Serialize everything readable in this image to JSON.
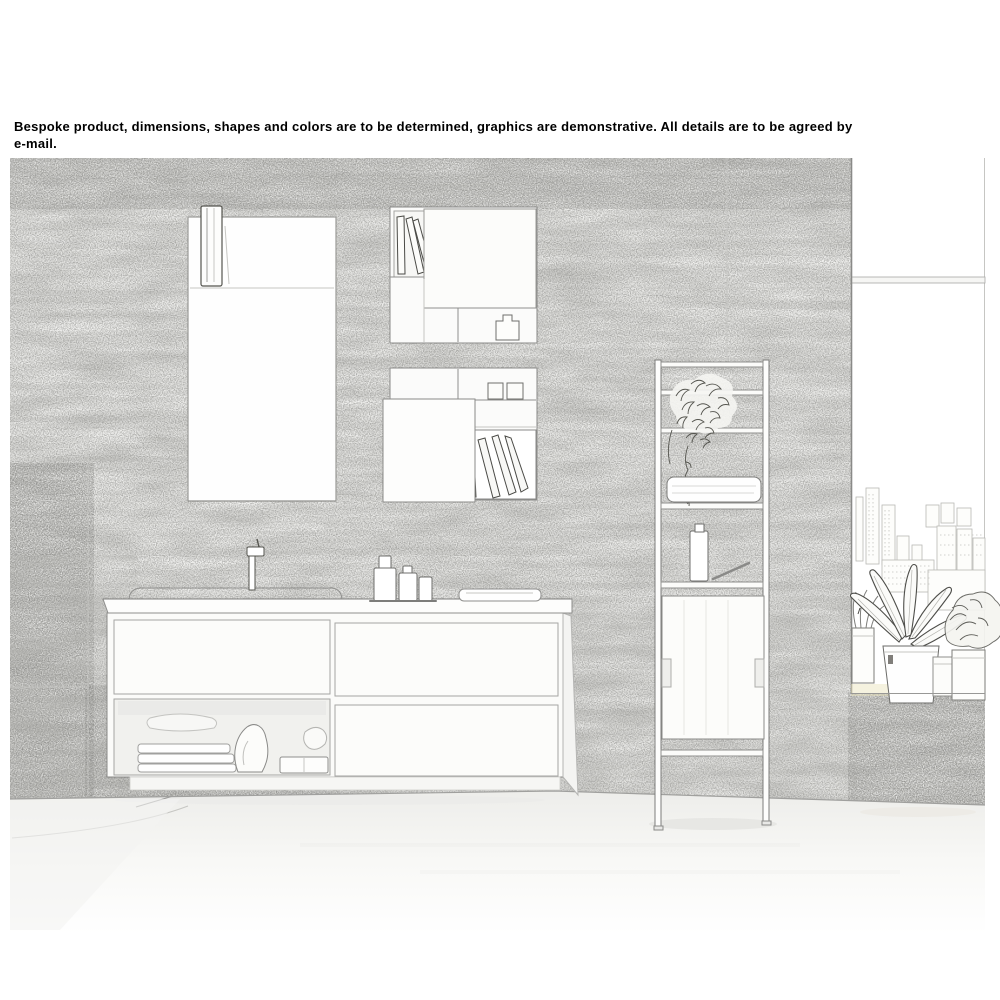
{
  "disclaimer": {
    "text": "Bespoke product, dimensions, shapes and colors are to be determined, graphics are demonstrative. All details are to be agreed by e-mail.",
    "lines": [
      "Bespoke product, dimensions, shapes and colors are to be determined, graphics are demonstrative. All details are to be agreed by",
      "e-mail."
    ]
  },
  "scene": {
    "style": "pencil-sketch line drawing of a product photo",
    "setting": "modern bathroom interior",
    "objects": [
      {
        "name": "stone-tile-wall",
        "label": "Textured stone slab wall"
      },
      {
        "name": "wall-mirror",
        "label": "Rectangular wall mirror with towel hanging at its left edge"
      },
      {
        "name": "box-shelf-upper",
        "label": "Wall-mounted open box shelf with leaning books and door panel"
      },
      {
        "name": "box-shelf-lower",
        "label": "Wall-mounted open box shelf with boxes and leaning books"
      },
      {
        "name": "vanity-unit",
        "label": "Wall-hung vanity with basin, faucet, soap bottles, tray, drawers and open towel shelf"
      },
      {
        "name": "ladder-shelf",
        "label": "Freestanding ladder shelf with trailing plant, folded towel, bottle and panel"
      },
      {
        "name": "window-city-view",
        "label": "Tall window with faint city-skyline view"
      },
      {
        "name": "potted-plants",
        "label": "Potted plants and planters on the window ledge"
      }
    ]
  },
  "colors": {
    "background": "#ffffff",
    "text": "#000000",
    "sketch_line": "#8f8f8d",
    "wall_tint": "#f3f3f1",
    "warm_tint": "#e9e3b8"
  }
}
